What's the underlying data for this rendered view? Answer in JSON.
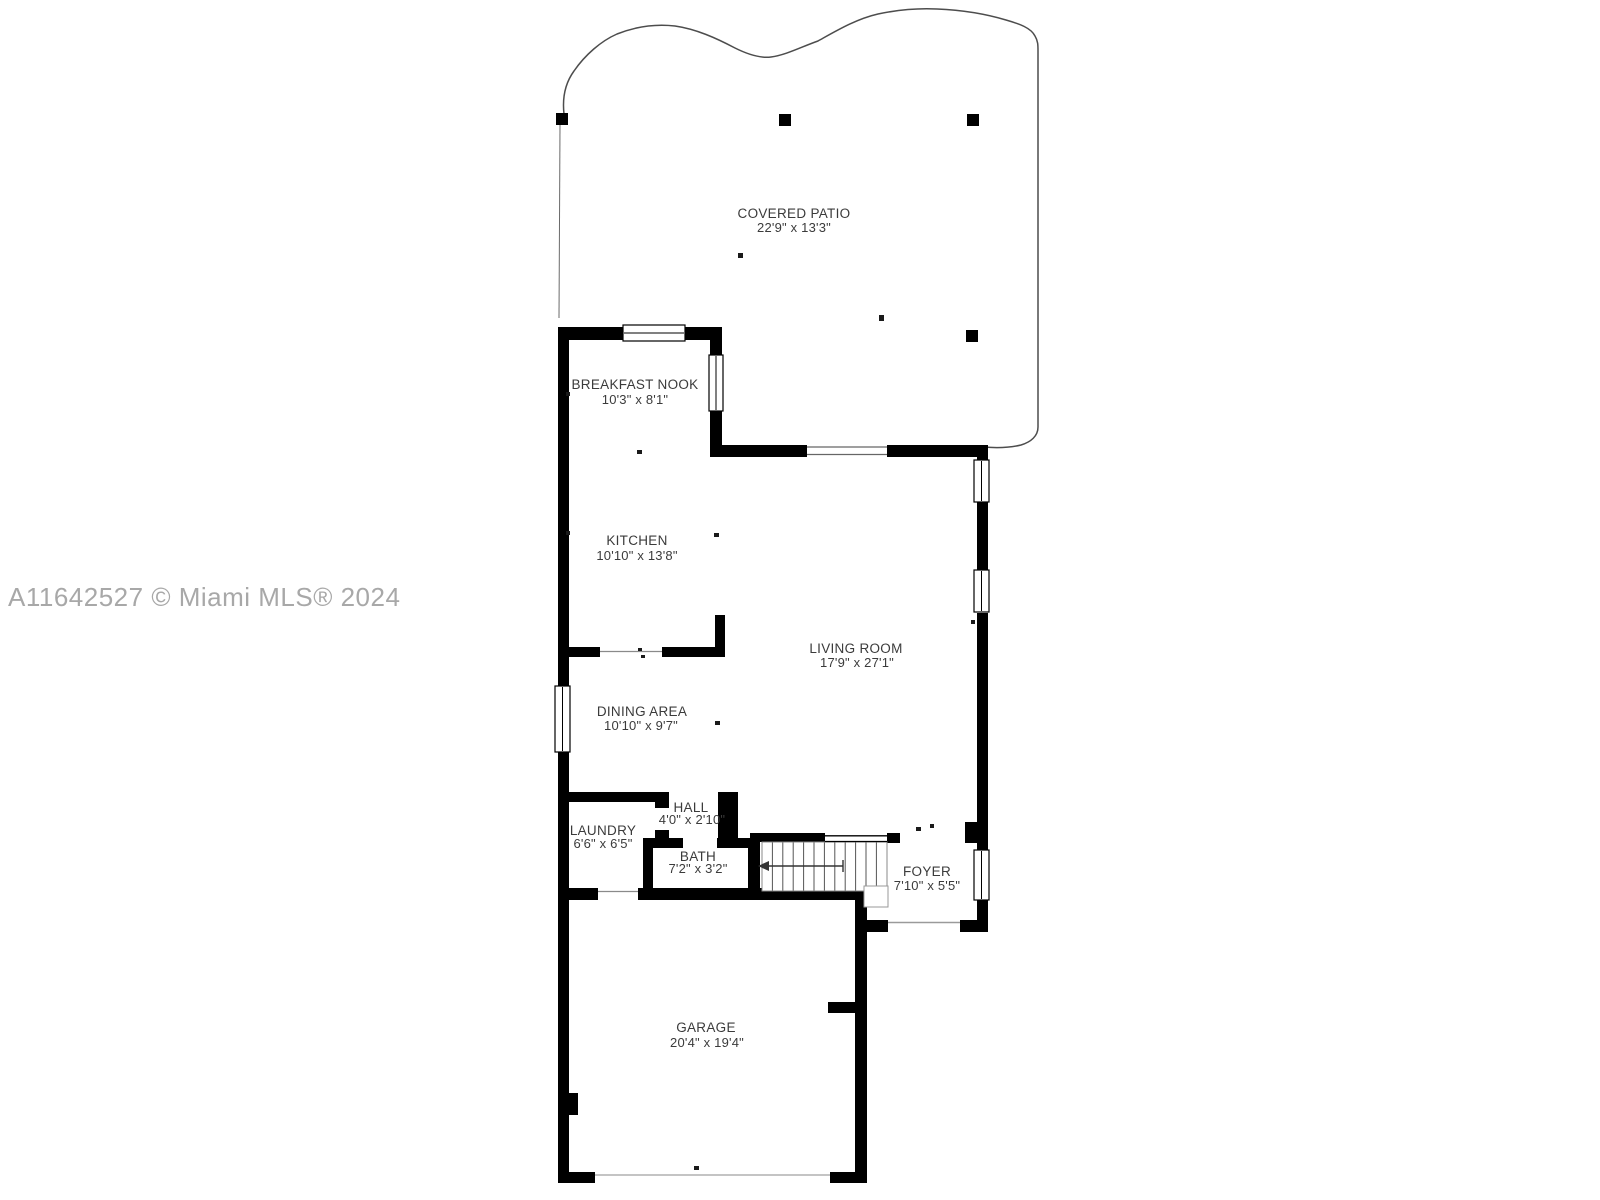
{
  "watermark": {
    "text": "A11642527 © Miami MLS® 2024",
    "color": "#a8a8a8"
  },
  "colors": {
    "background": "#ffffff",
    "wall": "#000000",
    "patio_outline": "#4d4d4d",
    "label_text": "#3b3b3b",
    "garage_door_line": "#c4c4c4"
  },
  "rooms": [
    {
      "id": "covered-patio",
      "name": "COVERED PATIO",
      "dims": "22'9\" x 13'3\""
    },
    {
      "id": "breakfast-nook",
      "name": "BREAKFAST NOOK",
      "dims": "10'3\" x 8'1\""
    },
    {
      "id": "kitchen",
      "name": "KITCHEN",
      "dims": "10'10\" x 13'8\""
    },
    {
      "id": "living-room",
      "name": "LIVING ROOM",
      "dims": "17'9\" x 27'1\""
    },
    {
      "id": "dining-area",
      "name": "DINING AREA",
      "dims": "10'10\" x 9'7\""
    },
    {
      "id": "hall",
      "name": "HALL",
      "dims": "4'0\" x 2'10\""
    },
    {
      "id": "laundry",
      "name": "LAUNDRY",
      "dims": "6'6\" x 6'5\""
    },
    {
      "id": "bath",
      "name": "BATH",
      "dims": "7'2\" x 3'2\""
    },
    {
      "id": "foyer",
      "name": "FOYER",
      "dims": "7'10\" x 5'5\""
    },
    {
      "id": "garage",
      "name": "GARAGE",
      "dims": "20'4\" x 19'4\""
    }
  ]
}
